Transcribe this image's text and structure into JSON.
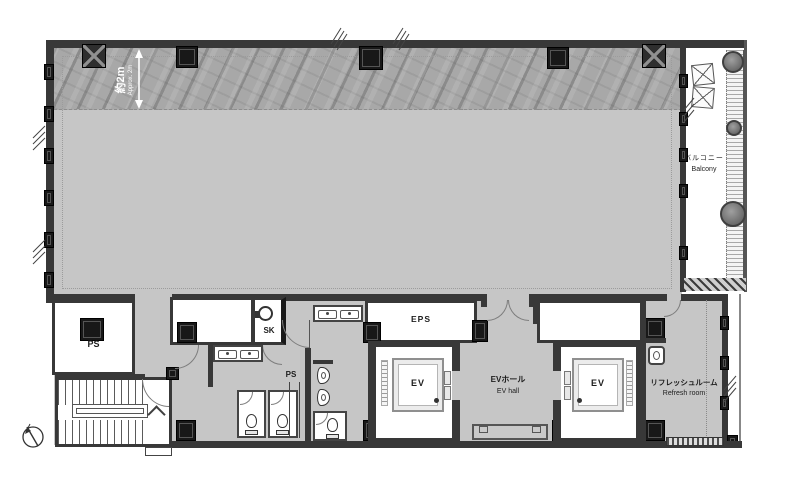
{
  "colors": {
    "wall": "#383838",
    "column": "#181818",
    "floor_gray": "#c6c6c6",
    "perimeter_band_gray": "#a8a8a8",
    "room_white": "#ffffff",
    "text": "#1d1d1d",
    "dimension_text": "#ffffff"
  },
  "plan": {
    "dimension": {
      "ja": "約2m",
      "en": "Approx. 2m"
    },
    "balcony": {
      "ja": "バルコニー",
      "en": "Balcony"
    },
    "rooms": {
      "ps_left": "PS",
      "sk": "SK",
      "ps_center": "PS",
      "eps": "EPS",
      "ev_left": "EV",
      "ev_right": "EV",
      "ev_hall": {
        "ja": "EVホール",
        "en": "EV hall"
      },
      "refresh": {
        "ja": "リフレッシュルーム",
        "en": "Refresh room"
      }
    }
  }
}
